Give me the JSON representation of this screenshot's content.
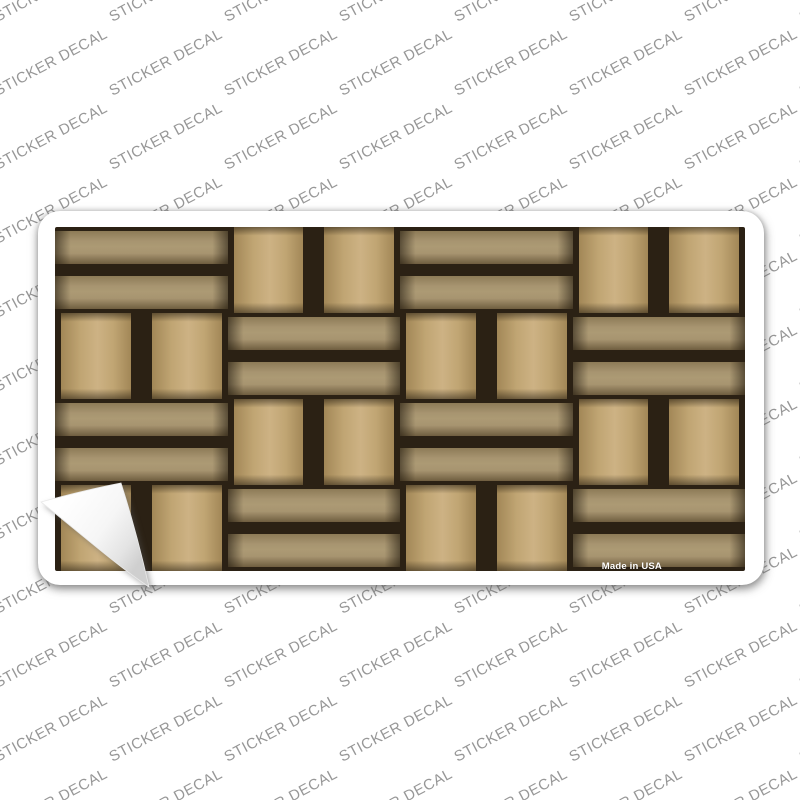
{
  "background": {
    "watermark_text": "STICKER DECAL"
  },
  "sticker": {
    "made_in_label": "Made in USA",
    "peel_corner": "bottom-left",
    "weave": {
      "grid": {
        "rows": 4,
        "cols": 4,
        "first_tile": "horizontal",
        "strips_per_tile": 2
      }
    }
  },
  "theme": {
    "page_bg": "#ffffff",
    "watermark_color": "#979797",
    "sticker_bg": "#ffffff",
    "gap_color": "#2b2114",
    "h_strip_edge": "#8d7b57",
    "h_strip_mid": "#a79470",
    "h_strip_highlight": "#ac9a74",
    "h_strip_shadow": "#6f5e40",
    "v_strip_mid": "#c0a573",
    "v_strip_highlight": "#cdb284",
    "v_strip_shadow": "#a28757",
    "made_in_color": "#ffffff",
    "flap_color": "#ffffff",
    "flap_fold_shade": "#cfcfcf"
  }
}
